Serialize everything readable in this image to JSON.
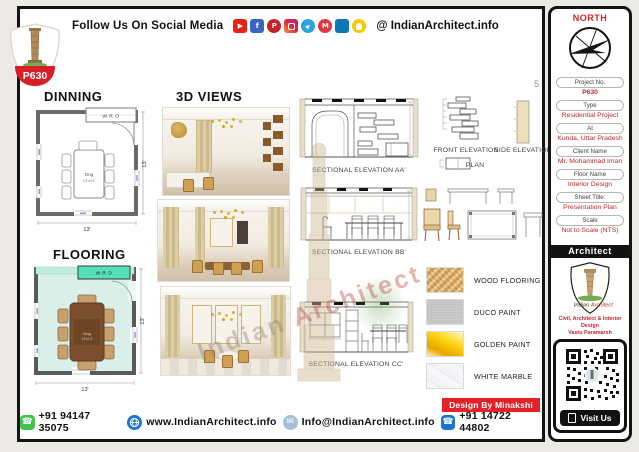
{
  "header": {
    "badge": "P630",
    "follow_text": "Follow Us On Social Media",
    "handle": "@ IndianArchitect.info",
    "social": [
      {
        "name": "youtube-icon",
        "glyph": "▶",
        "color": "#e62117"
      },
      {
        "name": "facebook-icon",
        "glyph": "f",
        "color": "#3a66c2"
      },
      {
        "name": "pinterest-icon",
        "glyph": "P",
        "color": "#cb2027"
      },
      {
        "name": "instagram-icon",
        "glyph": "",
        "color": "#d62976"
      },
      {
        "name": "telegram-icon",
        "glyph": "▶",
        "color": "#2aa3e0"
      },
      {
        "name": "moj-icon",
        "glyph": "M",
        "color": "#e23744"
      },
      {
        "name": "linkedin-icon",
        "glyph": "in",
        "color": "#0a78b5"
      },
      {
        "name": "snapchat-icon",
        "glyph": "",
        "color": "#f5c800"
      }
    ]
  },
  "north": "NORTH",
  "page_number": "5",
  "titles": {
    "dinning": "DINNING",
    "flooring": "FLOORING",
    "views": "3D  VIEWS"
  },
  "plan": {
    "wro": "W.R.O",
    "wrd": "W.R.D",
    "room_abbr": "Dng",
    "room_size": "13'x13'",
    "dim": "13'"
  },
  "elevations": {
    "aa": "SECTIONAL ELEVATION AA'",
    "bb": "SECTIONAL ELEVATION BB'",
    "cc": "SECTIONAL ELEVATION CC'",
    "front": "FRONT ELEVATION",
    "side": "SIDE ELEVATION",
    "plan": "PLAN"
  },
  "legend": [
    {
      "name": "WOOD FLOORING",
      "color": "#e3c390"
    },
    {
      "name": "DUCO PAINT",
      "color": "#c6c6c6"
    },
    {
      "name": "GOLDEN PAINT",
      "color": "#f3c117"
    },
    {
      "name": "WHITE MARBLE",
      "color": "#f4f4f6"
    }
  ],
  "sidebar": {
    "fields": [
      {
        "label": "Project No.",
        "value": "P630"
      },
      {
        "label": "Type",
        "value": "Residential Project"
      },
      {
        "label": "At",
        "value": "Kunda, Uttar Pradesh"
      },
      {
        "label": "Client Name",
        "value": "Mr. Mohammad Iman"
      },
      {
        "label": "Floor Name",
        "value": "Interior Design"
      },
      {
        "label": "Sheet Title:",
        "value": "Presentation Plan"
      },
      {
        "label": "Scale",
        "value": "Not to Scale (NTS)"
      }
    ],
    "architect_header": "Architect",
    "logo_word1": "Indian",
    "logo_word2": "Architect",
    "tagline1": "Civil, Architect & Interior Design",
    "tagline2": "Vastu Paramarsh",
    "visit_us": "Visit Us"
  },
  "watermark": {
    "word1": "Indian",
    "word2": "Architect"
  },
  "footer": {
    "whatsapp": "+91 94147 35075",
    "website": "www.IndianArchitect.info",
    "email": "Info@IndianArchitect.info",
    "phone": "+91 14722 44802",
    "design_by": "Design By Minakshi"
  },
  "colors": {
    "accent_red": "#c4272e",
    "mint_floor": "#d9efe7",
    "wrd_green": "#57e0b5",
    "gold": "#c9a96a",
    "table_brown": "#7b4f2e"
  }
}
